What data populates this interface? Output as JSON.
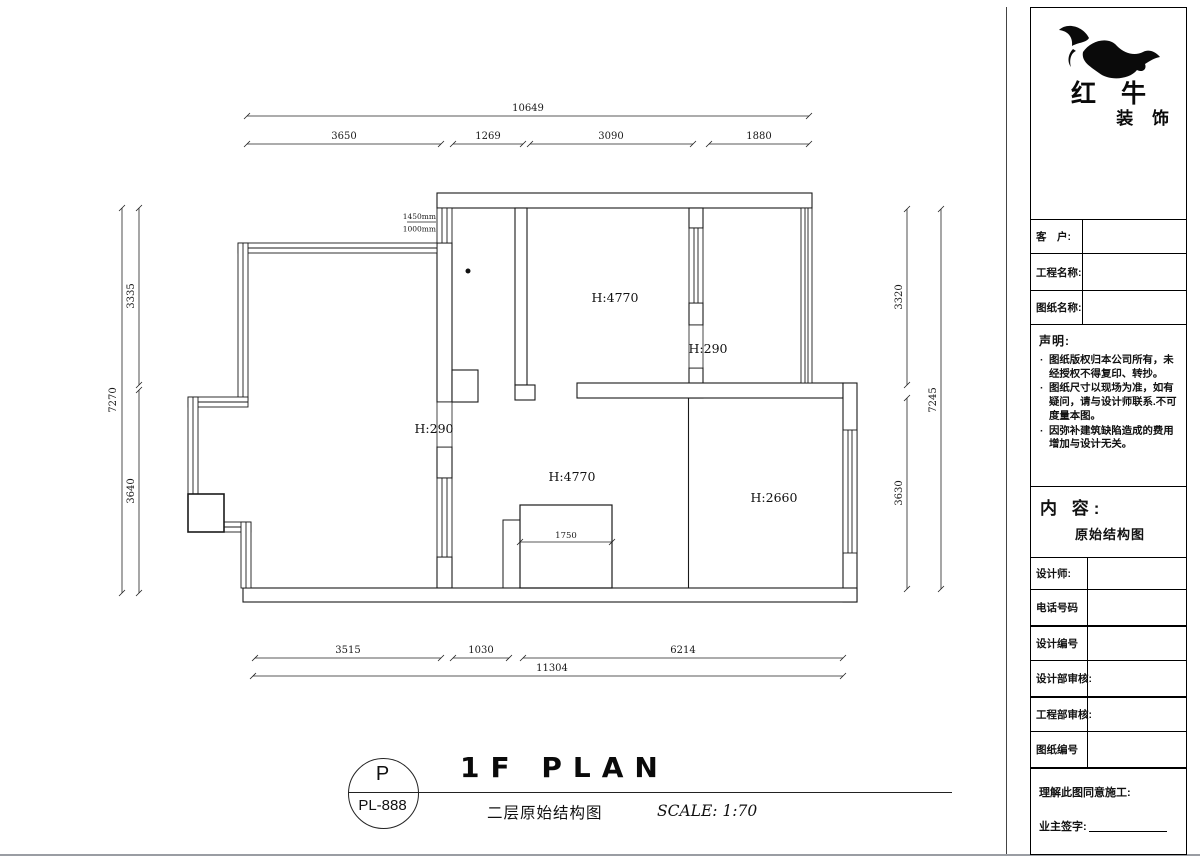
{
  "sheet": {
    "footer": {
      "stamp_top": "P",
      "stamp_code": "PL-888",
      "title": "1F PLAN",
      "subtitle": "二层原始结构图",
      "scale": "SCALE: 1:70"
    },
    "titleblock": {
      "brand_main": "红 牛",
      "brand_sub": "装 饰",
      "field_client": "客　户:",
      "field_project": "工程名称:",
      "field_drawing": "图纸名称:",
      "statement_title": "声明:",
      "statement_items": [
        "图纸版权归本公司所有，未经授权不得复印、转抄。",
        "图纸尺寸以现场为准，如有疑问，请与设计师联系.不可度量本图。",
        "因弥补建筑缺陷造成的费用增加与设计无关。"
      ],
      "content_label": "内 容:",
      "content_value": "原始结构图",
      "row_designer": "设计师:",
      "row_phone": "电话号码",
      "row_design_no": "设计编号",
      "row_design_audit": "设计部审核:",
      "row_eng_audit": "工程部审核:",
      "row_drawing_no": "图纸编号",
      "approval_text": "理解此图同意施工:",
      "signature_label": "业主签字:"
    }
  },
  "plan": {
    "heights": {
      "room_top": "H:4770",
      "beam_top": "H:290",
      "beam_left": "H:290",
      "room_main": "H:4770",
      "room_right": "H:2660"
    },
    "window_note_top": "1450mm",
    "window_note_bottom": "1000mm",
    "stair_width": "1750",
    "dims": {
      "top_overall": "10649",
      "top_seg": [
        "3650",
        "1269",
        "3090",
        "1880"
      ],
      "bottom_seg": [
        "3515",
        "1030",
        "6214"
      ],
      "bottom_overall": "11304",
      "left_overall": "7270",
      "left_seg": [
        "3335",
        "3640"
      ],
      "right_seg": [
        "3320",
        "3630"
      ],
      "right_overall": "7245"
    }
  }
}
